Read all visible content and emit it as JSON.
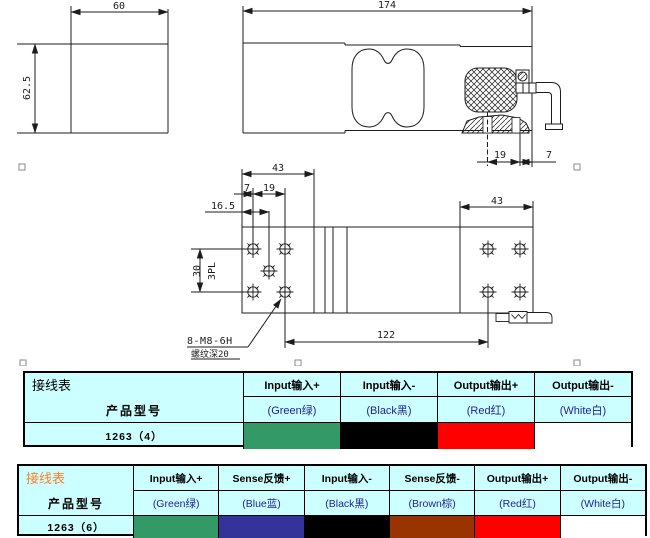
{
  "drawing": {
    "dims": {
      "front_width": "60",
      "front_height": "62.5",
      "side_length": "174",
      "side_cable_pitch": "19",
      "side_cable_end": "7",
      "top_left_width": "43",
      "top_edge_offset": "7",
      "top_hole_pitch_x": "19",
      "top_center_offset": "16.5",
      "top_hole_pitch_y": "30",
      "top_hole_pitch_note": "3PL",
      "top_right_width": "43",
      "top_hole_span": "122",
      "thread_callout": "8-M8-6H",
      "thread_note": "螺纹深20"
    }
  },
  "table_4wire": {
    "title": "接线表",
    "product_label": "产品型号",
    "model": "1263（4）",
    "columns": [
      {
        "header": "Input输入+",
        "wire": "(Green绿)",
        "color": "#339966"
      },
      {
        "header": "Input输入-",
        "wire": "(Black黑)",
        "color": "#000000"
      },
      {
        "header": "Output输出+",
        "wire": "(Red红)",
        "color": "#FF0000"
      },
      {
        "header": "Output输出-",
        "wire": "(White白)",
        "color": "#FFFFFF"
      }
    ]
  },
  "table_6wire": {
    "title": "接线表",
    "product_label": "产品型号",
    "model": "1263（6）",
    "columns": [
      {
        "header": "Input输入+",
        "wire": "(Green绿)",
        "color": "#339966"
      },
      {
        "header": "Sense反馈+",
        "wire": "(Blue蓝)",
        "color": "#333399"
      },
      {
        "header": "Input输入-",
        "wire": "(Black黑)",
        "color": "#000000"
      },
      {
        "header": "Sense反馈-",
        "wire": "(Brown棕)",
        "color": "#993300"
      },
      {
        "header": "Output输出+",
        "wire": "(Red红)",
        "color": "#FF0000"
      },
      {
        "header": "Output输出-",
        "wire": "(White白)",
        "color": "#FFFFFF"
      }
    ]
  },
  "colors": {
    "table_bg": "#CCFFFF",
    "accent_title": "#FF7F27",
    "wire_text": "#1F1F96"
  }
}
